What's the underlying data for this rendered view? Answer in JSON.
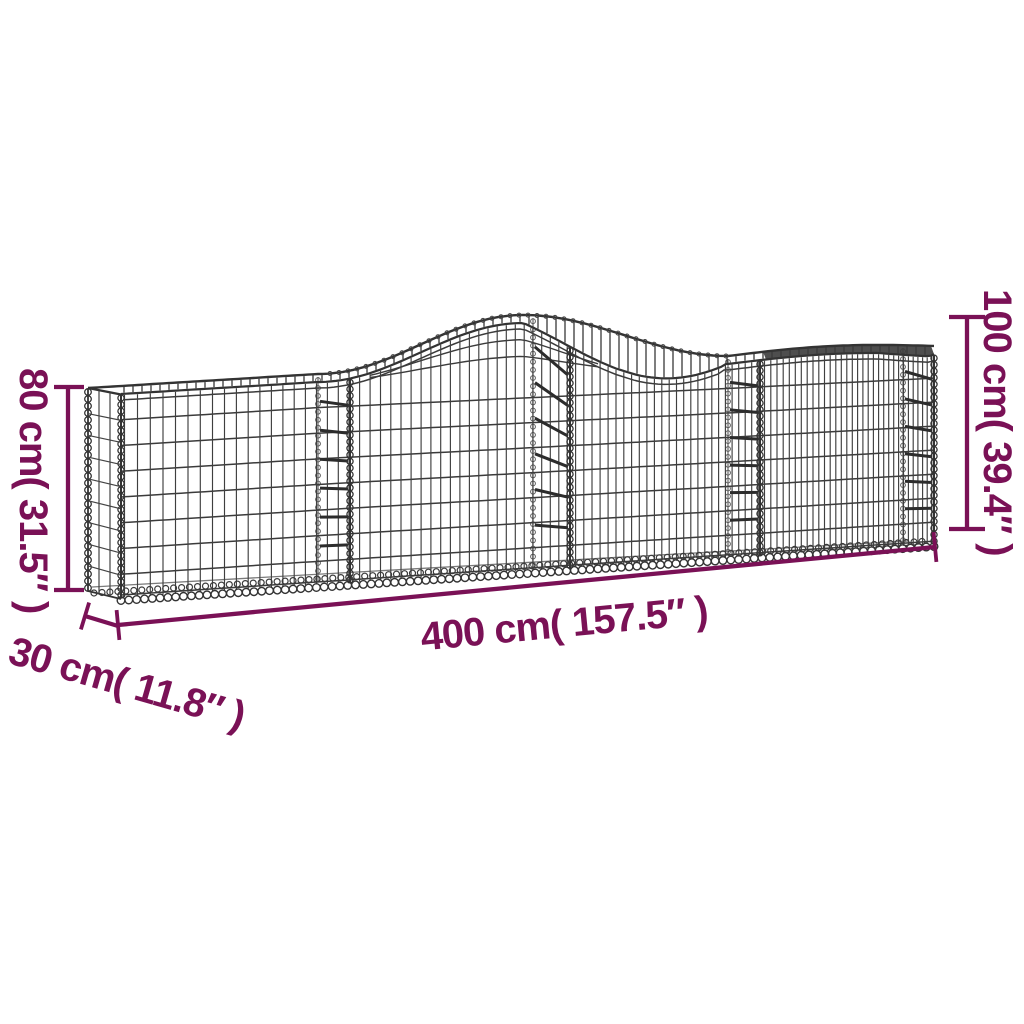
{
  "diagram": {
    "subject": "Arched gabion basket dimension drawing",
    "dimensions": {
      "length_label": "400 cm( 157.5″ )",
      "end_height_label": "80 cm( 31.5″ )",
      "arch_height_label": "100 cm( 39.4″ )",
      "depth_label": "30 cm( 11.8″ )"
    },
    "colors": {
      "annotation": "#7a1156",
      "wire": "#3b3b3b",
      "background": "#ffffff"
    }
  }
}
